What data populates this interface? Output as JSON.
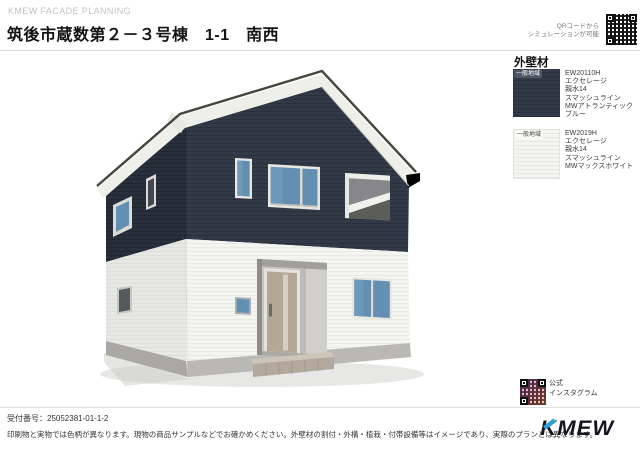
{
  "header": {
    "brand": "KMEW FACADE PLANNING",
    "title": "筑後市蔵数第２－３号棟　1-1　南西",
    "qr_caption_line1": "QRコードから",
    "qr_caption_line2": "シミュレーションが可能"
  },
  "materials_panel": {
    "heading": "外壁材",
    "items": [
      {
        "region_label": "一般地域",
        "code": "EW20110H",
        "series": "エクセレージ",
        "grade": "親水14",
        "pattern": "スマッシュライン",
        "color_name": "MWアトランティックブルー",
        "swatch_color": "#323a48"
      },
      {
        "region_label": "一般地域",
        "code": "EW2019H",
        "series": "エクセレージ",
        "grade": "親水14",
        "pattern": "スマッシュライン",
        "color_name": "MWマックスホワイト",
        "swatch_color": "#f4f4f1"
      }
    ]
  },
  "instagram": {
    "line1": "公式",
    "line2": "インスタグラム"
  },
  "footer": {
    "receipt": "受付番号：25052381-01-1-2",
    "disclaimer": "印刷物と実物では色柄が異なります。現物の商品サンプルなどでお確かめください。外壁材の割付・外構・植栽・付帯設備等はイメージであり、実際のプランとは異なります。",
    "logo_text": "KMEW"
  },
  "render": {
    "colors": {
      "siding_navy": "#323a48",
      "siding_navy_shade": "#28303c",
      "siding_white": "#f4f4f1",
      "siding_white_shade": "#e7e7e4",
      "foundation": "#b9b8b4",
      "foundation_shade": "#a9a8a4",
      "fascia": "#efefe9",
      "roof_edge": "#46463f",
      "glass_blue": "#6390b2",
      "glass_dark": "#434850",
      "door_greige": "#b4a795",
      "accent_blue": "#2aa3db"
    }
  }
}
